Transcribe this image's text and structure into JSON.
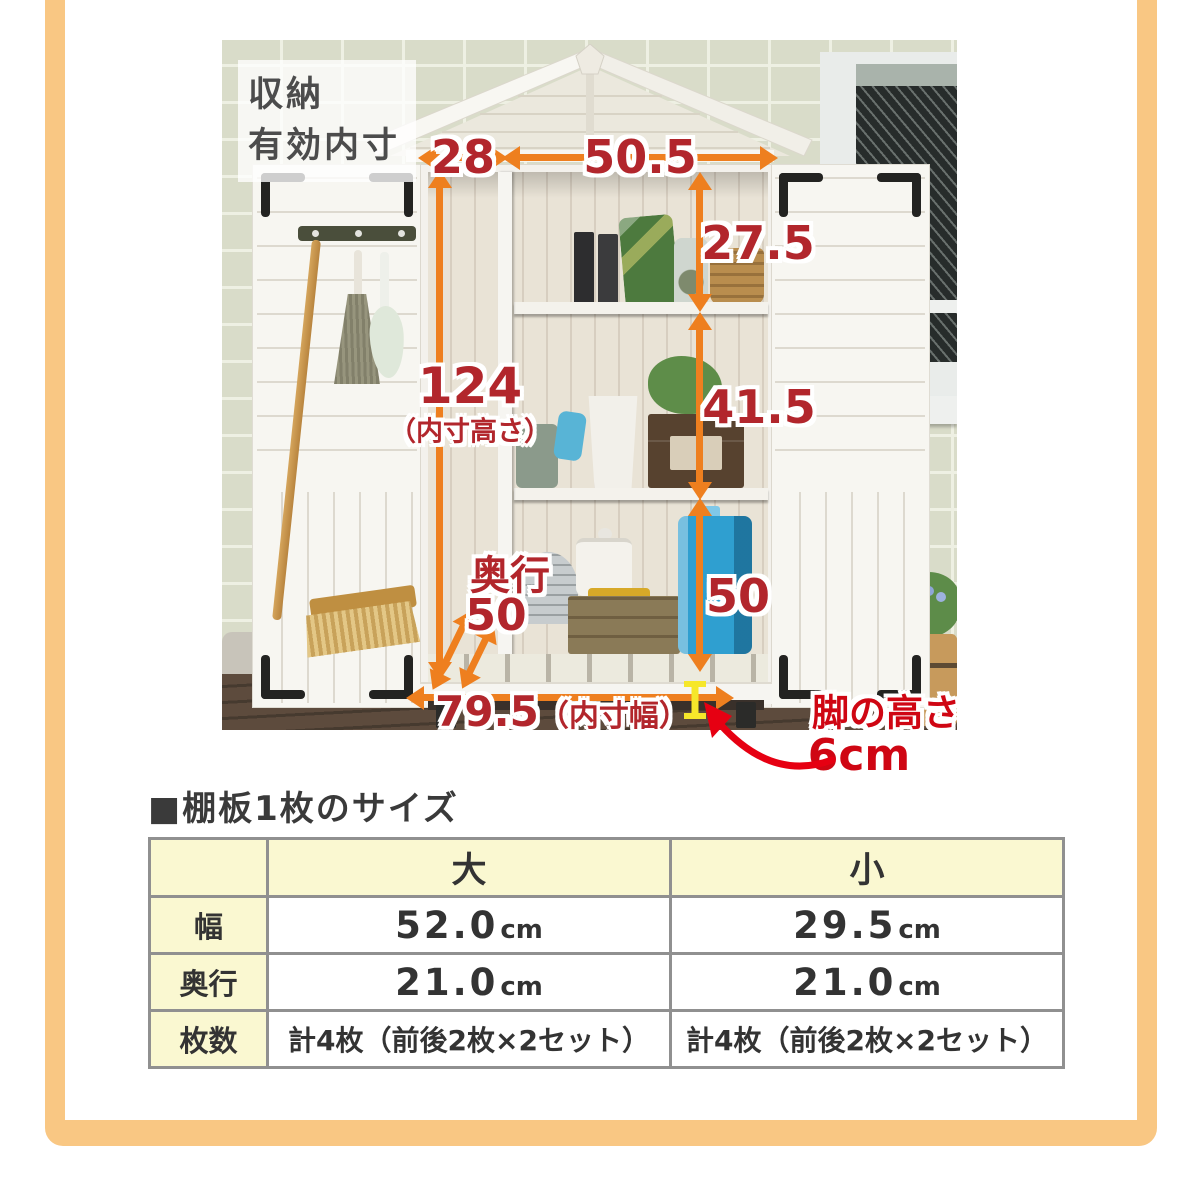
{
  "colors": {
    "frame_orange": "#f9c783",
    "arrow_orange": "#ee7f1f",
    "dimension_red": "#b2262c",
    "leg_red": "#cf0613",
    "marker_yellow": "#f6e72a",
    "table_header_bg": "#faf8d1",
    "table_border": "#909090"
  },
  "photo": {
    "caption": {
      "line1": "収納",
      "line2": "有効内寸"
    },
    "dims": {
      "left_width": "28",
      "right_width": "50.5",
      "top_height": "27.5",
      "total_height": "124",
      "total_height_note": "（内寸高さ）",
      "middle_height": "41.5",
      "bottom_height": "50",
      "depth_label": "奥行",
      "depth_value": "50",
      "inner_width": "79.5",
      "inner_width_note": "（内寸幅）",
      "leg_label": "脚の高さ",
      "leg_value": "6cm"
    }
  },
  "table": {
    "title": "■棚板1枚のサイズ",
    "columns": [
      "",
      "大",
      "小"
    ],
    "rows": [
      {
        "label": "幅",
        "cells": [
          {
            "num": "52.0",
            "unit": "cm"
          },
          {
            "num": "29.5",
            "unit": "cm"
          }
        ]
      },
      {
        "label": "奥行",
        "cells": [
          {
            "num": "21.0",
            "unit": "cm"
          },
          {
            "num": "21.0",
            "unit": "cm"
          }
        ]
      },
      {
        "label": "枚数",
        "cells": [
          {
            "text": "計4枚（前後2枚×2セット）"
          },
          {
            "text": "計4枚（前後2枚×2セット）"
          }
        ]
      }
    ]
  }
}
